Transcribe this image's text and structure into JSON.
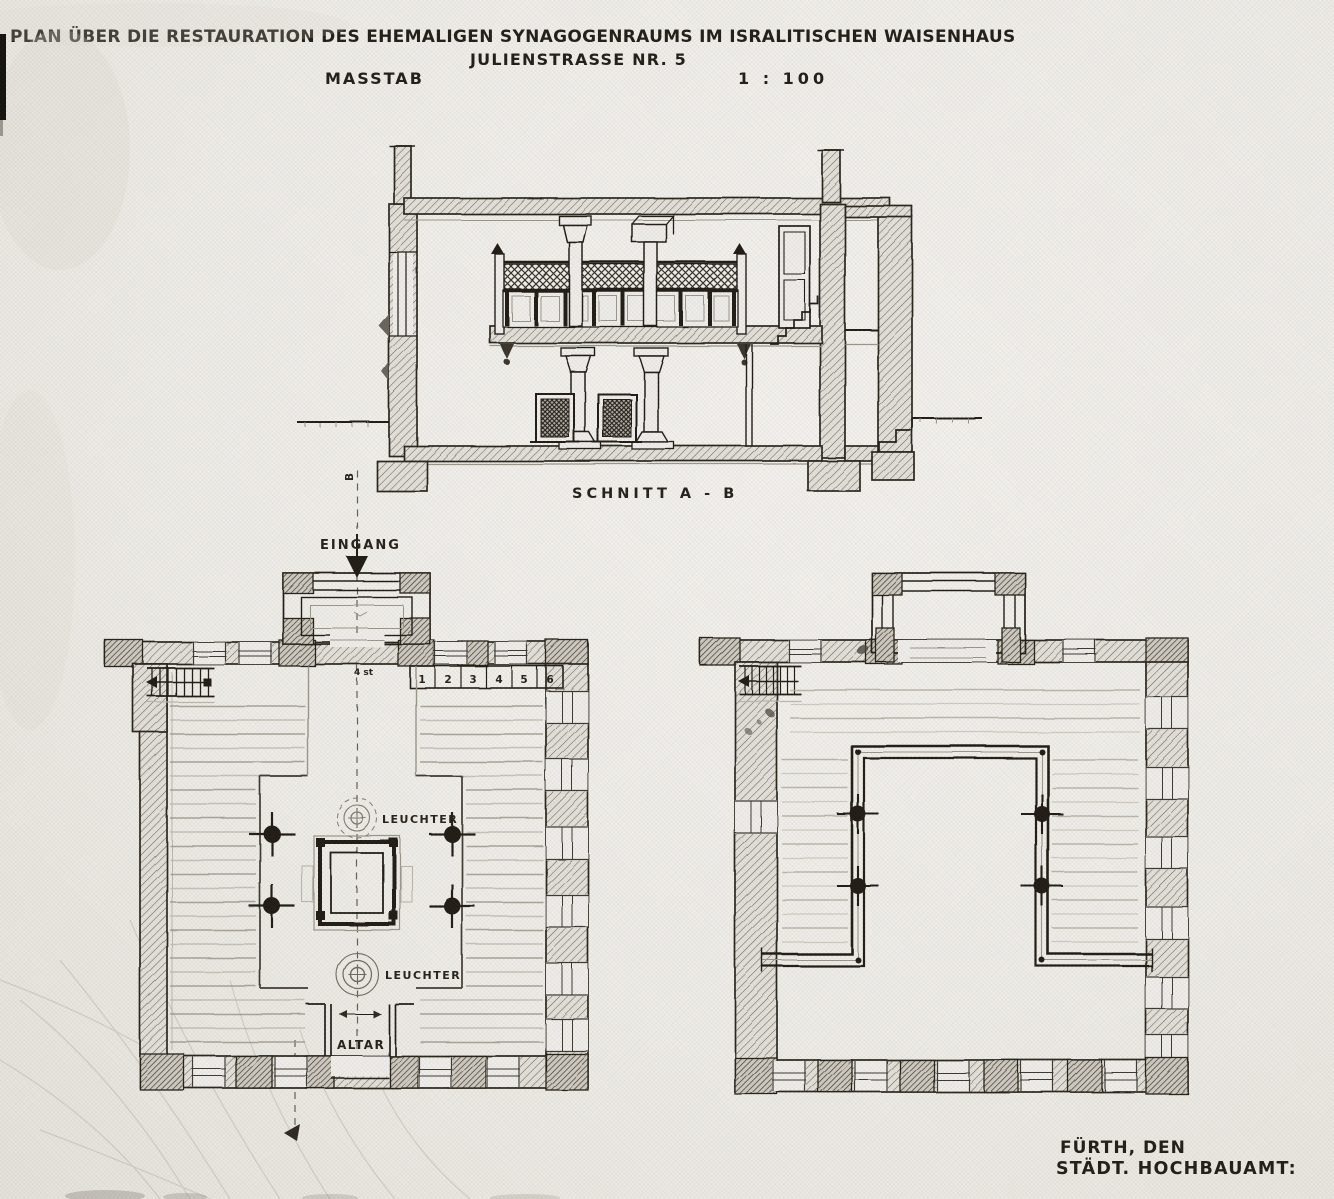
{
  "document": {
    "title_line1": "PLAN ÜBER DIE RESTAURATION DES EHEMALIGEN SYNAGOGENRAUMS IM ISRALITISCHEN WAISENHAUS",
    "title_line2": "JULIENSTRASSE NR. 5",
    "scale_label": "MASSTAB",
    "scale_value": "1 : 100",
    "footer_city": "FÜRTH, DEN",
    "footer_office": "STÄDT. HOCHBAUAMT:"
  },
  "section_view": {
    "caption": "SCHNITT A - B",
    "axis_end_marker": "B"
  },
  "ground_floor_plan": {
    "entrance_label": "EINGANG",
    "vestibule_steps_note": "4 st",
    "upper_chandelier_label": "LEUCHTER",
    "lower_chandelier_label": "LEUCHTER",
    "altar_label": "ALTAR",
    "seat_numbers": [
      "1",
      "2",
      "3",
      "4",
      "5",
      "6"
    ]
  },
  "colors": {
    "paper": "#efede9",
    "ink": "#221e19",
    "pencil": "#a29d93"
  }
}
